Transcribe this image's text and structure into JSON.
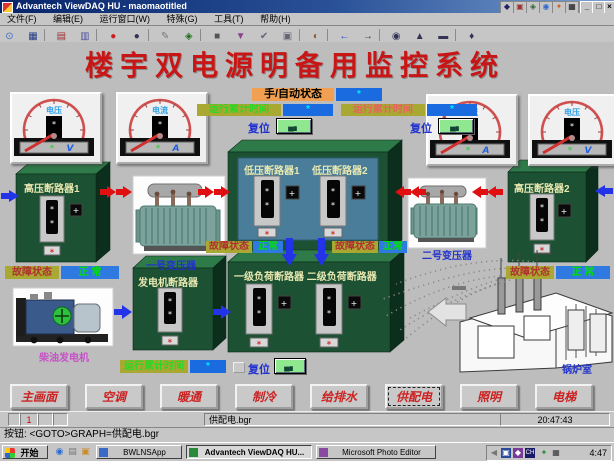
{
  "window": {
    "title": "Advantech ViewDAQ HU - maomaotitled",
    "menu_items": [
      "文件(F)",
      "编辑(E)",
      "运行窗口(W)",
      "特殊(G)",
      "工具(T)",
      "帮助(H)"
    ],
    "toolbar": [
      {
        "name": "search-icon",
        "glyph": "⊙"
      },
      {
        "name": "monitor-icon",
        "glyph": "▦"
      },
      {
        "name": "printer-icon",
        "glyph": "▤"
      },
      {
        "name": "chart-icon",
        "glyph": "▥"
      },
      {
        "name": "tag-icon",
        "glyph": "◆"
      },
      {
        "name": "red-alarm-icon",
        "glyph": "●"
      },
      {
        "name": "red-bell-icon",
        "glyph": "●"
      },
      {
        "name": "pen-icon",
        "glyph": "✎"
      },
      {
        "name": "key-icon",
        "glyph": "◈"
      },
      {
        "name": "camera-icon",
        "glyph": "■"
      },
      {
        "name": "green-check-icon",
        "glyph": "▼"
      },
      {
        "name": "confirm-icon",
        "glyph": "✔"
      },
      {
        "name": "copy-icon",
        "glyph": "▣"
      },
      {
        "name": "palette-icon",
        "glyph": "◐"
      },
      {
        "name": "arrow-left-icon",
        "glyph": "←"
      },
      {
        "name": "arrow-right-icon",
        "glyph": "→"
      },
      {
        "name": "globe-icon",
        "glyph": "◉"
      },
      {
        "name": "user-icon",
        "glyph": "▲"
      },
      {
        "name": "film-icon",
        "glyph": "▬"
      },
      {
        "name": "operator-icon",
        "glyph": "♦"
      }
    ],
    "win_buttons": {
      "minimize": "_",
      "restore": "□",
      "close": "×"
    }
  },
  "hmi": {
    "main_title": "楼宇双电源明备用监控系统",
    "gauges": [
      {
        "label": "电压",
        "unit": "V",
        "value": "*"
      },
      {
        "label": "电流",
        "unit": "A",
        "value": "*"
      },
      {
        "label": "电流",
        "unit": "A",
        "value": "*"
      },
      {
        "label": "电压",
        "unit": "V",
        "value": "*"
      }
    ],
    "mode": {
      "label": "手/自动状态",
      "value": "*"
    },
    "runtime_top": [
      {
        "label": "运行累计时间",
        "value": "*",
        "reset_label": "复位"
      },
      {
        "label": "运行累计时间",
        "value": "*",
        "reset_label": "复位"
      }
    ],
    "runtime_bottom": {
      "label": "运行累计时间",
      "value": "*",
      "reset_label": "复位"
    },
    "boxes": {
      "hv1_title": "高压断路器1",
      "hv2_title": "高压断路器2",
      "lv1_title": "低压断路器1",
      "lv2_title": "低压断路器2",
      "gen_title": "发电机断路器",
      "load_title": "一级负荷断路器 二级负荷断路器"
    },
    "labels": {
      "transformer1": "一号变压器",
      "transformer2": "二号变压器",
      "generator": "柴油发电机",
      "boiler": "锅炉室"
    },
    "fault_status": [
      {
        "label": "故障状态",
        "value": "正 常"
      },
      {
        "label": "故障状态",
        "value": "正常"
      },
      {
        "label": "故障状态",
        "value": "正常"
      },
      {
        "label": "故障状态",
        "value": "正 常"
      }
    ],
    "display_value": "*",
    "breaker_button": "+"
  },
  "nav": {
    "buttons": [
      "主画面",
      "空调",
      "暖通",
      "制冷",
      "给排水",
      "供配电",
      "照明",
      "电梯"
    ],
    "active": "供配电"
  },
  "statusbar": {
    "page_cell": "1",
    "file": "供配电.bgr",
    "clock": "20:47:43",
    "message": "按钮: <GOTO>GRAPH=供配电.bgr"
  },
  "taskbar": {
    "start_label": "开始",
    "tasks": [
      "BWLNSApp",
      "Advantech ViewDAQ HU...",
      "Microsoft Photo Editor"
    ],
    "tray_time": "4:47"
  },
  "colors": {
    "title_red": "#c81616",
    "box_green": "#1c5134",
    "panel_blue": "#4a7d99",
    "value_blue": "#1a6ae0",
    "label_olive": "#a8a832",
    "label_orange": "#f0a050",
    "status_green": "#00e000",
    "nav_red": "#cc2222"
  }
}
